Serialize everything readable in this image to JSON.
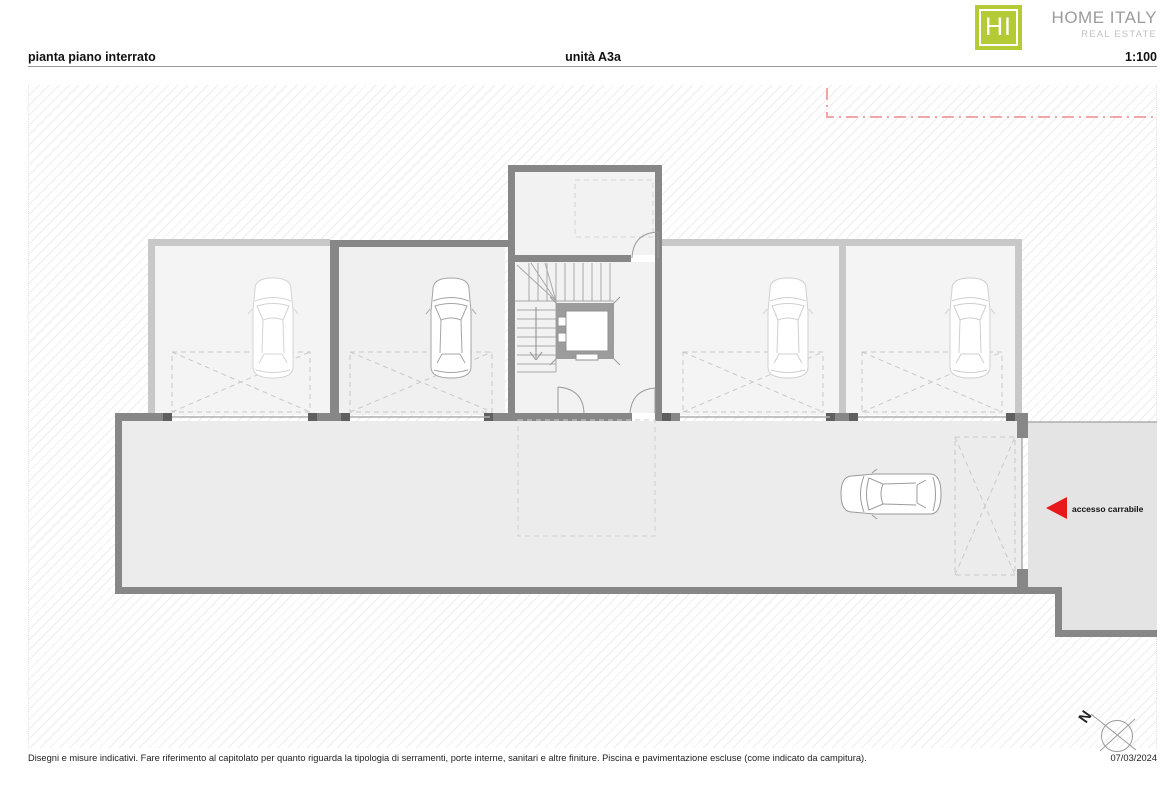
{
  "brand": {
    "initials": "HI",
    "name": "HOME ITALY",
    "tagline": "REAL ESTATE",
    "logo_color": "#b5cb35"
  },
  "header": {
    "title": "pianta piano interrato",
    "unit": "unità A3a",
    "scale": "1:100"
  },
  "plan": {
    "access_label": "accesso carrabile",
    "north_label": "N",
    "colors": {
      "wall_dark": "#878787",
      "wall_light": "#c8c8c8",
      "pier_dark": "#5f5f5f",
      "room_fill": "#f2f2f2",
      "garage_fill": "#f4f4f4",
      "driveway_fill": "#ececec",
      "ramp_fill": "#e4e4e4",
      "accent_red": "#e8191d",
      "boundary_pink": "#f3a6a6"
    }
  },
  "footer": {
    "disclaimer": "Disegni e misure indicativi. Fare riferimento al capitolato per quanto riguarda la tipologia di serramenti, porte interne, sanitari e altre finiture. Piscina e pavimentazione escluse (come indicato da campitura).",
    "date": "07/03/2024"
  }
}
